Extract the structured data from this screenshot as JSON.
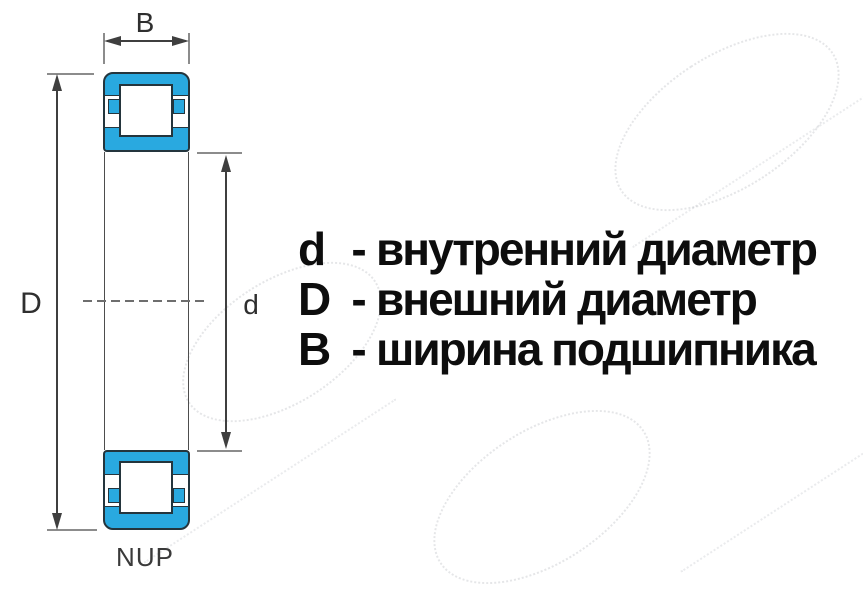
{
  "diagram": {
    "dimension_labels": {
      "width": "B",
      "outer_diameter": "D",
      "inner_diameter": "d"
    },
    "bearing_type_label": "NUP",
    "colors": {
      "bearing_fill": "#29A9E0",
      "outline": "#24353D",
      "dimension_line": "#3F3F3F",
      "extension_line": "#8C8C8C",
      "label_text": "#2F2F2F",
      "legend_text": "#0D0D0D"
    },
    "icons": {
      "arrowhead-up": "css-triangle-up",
      "arrowhead-down": "css-triangle-down",
      "arrowhead-left": "css-triangle-left",
      "arrowhead-right": "css-triangle-right"
    }
  },
  "legend": {
    "separator": "-",
    "items": [
      {
        "symbol": "d",
        "term": "внутренний диаметр"
      },
      {
        "symbol": "D",
        "term": "внешний диаметр"
      },
      {
        "symbol": "B",
        "term": "ширина подшипника"
      }
    ]
  }
}
